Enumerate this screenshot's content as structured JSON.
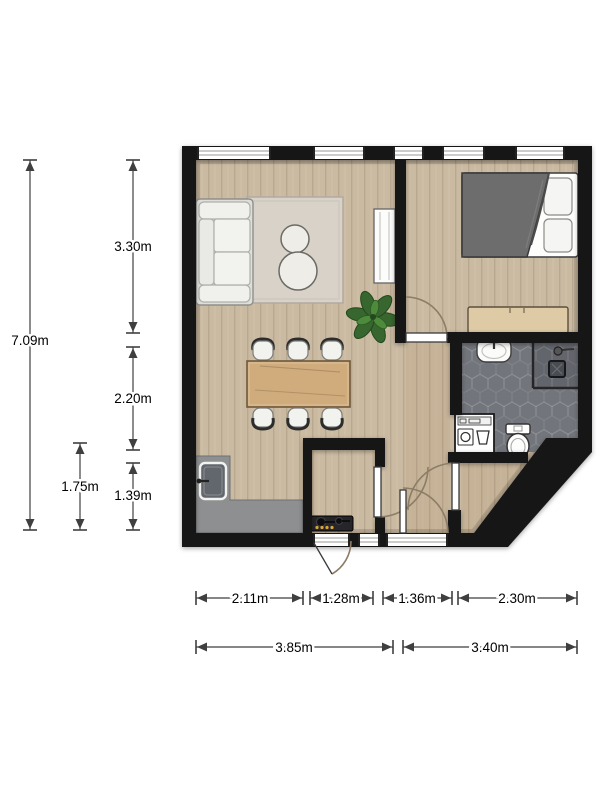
{
  "title": "apartment-floor-plan",
  "dimensions": {
    "vertical": [
      {
        "id": "total-depth",
        "label": "7.09m"
      },
      {
        "id": "living-depth",
        "label": "3.30m"
      },
      {
        "id": "dining-depth",
        "label": "2.20m"
      },
      {
        "id": "kitchen-depth",
        "label": "1.39m"
      },
      {
        "id": "counter-span",
        "label": "1.75m"
      }
    ],
    "horizontal_segments": [
      {
        "id": "kitchen-width",
        "label": "2.11m"
      },
      {
        "id": "closet-width",
        "label": "1.28m"
      },
      {
        "id": "hall-width",
        "label": "1.36m"
      },
      {
        "id": "bathroom-width",
        "label": "2.30m"
      }
    ],
    "horizontal_totals": [
      {
        "id": "left-width",
        "label": "3.85m"
      },
      {
        "id": "right-width",
        "label": "3.40m"
      }
    ]
  },
  "rooms": [
    "living-room",
    "dining-area",
    "kitchen",
    "entry-closet",
    "hallway",
    "bedroom",
    "bathroom"
  ],
  "fixtures": [
    "sofa",
    "rug",
    "coffee-tables",
    "radiator",
    "plant",
    "dining-table",
    "dining-chair",
    "kitchen-counter",
    "kitchen-sink",
    "stove",
    "bed",
    "pillow",
    "sideboard",
    "bathroom-sink",
    "shower",
    "shower-drain",
    "washing-machine",
    "toilet",
    "interior-door",
    "front-door",
    "window"
  ],
  "colors": {
    "wall": "#161616",
    "floor": "#cbbaa2",
    "tile": "#72757b",
    "shower": "#5d6066",
    "counter": "#8d8f90",
    "rug": "#d8d2c8",
    "furniture-wood": "#d0ab7c",
    "sideboard-wood": "#decaa4",
    "duvet": "#6d6d6d",
    "plant": "#37662e",
    "arc": "#8d7d66",
    "dimension": "#3f3f3f",
    "knob": "#d9a43b"
  }
}
